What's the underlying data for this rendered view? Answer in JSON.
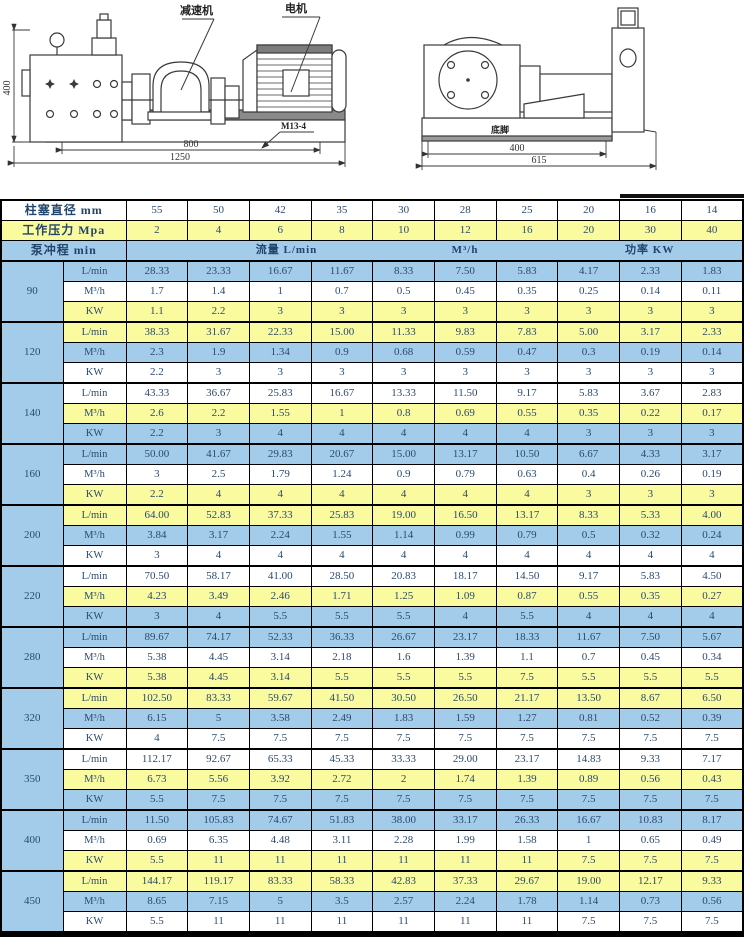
{
  "diagram": {
    "label_reducer": "减速机",
    "label_motor": "电机",
    "label_bolt": "M13-4",
    "label_foot": "底脚",
    "dim_left_height": "400",
    "dim_base": "800",
    "dim_total": "1250",
    "dim_side_base": "400",
    "dim_side_total": "615"
  },
  "table": {
    "header": {
      "diameter_label": "柱塞直径 mm",
      "diameters": [
        "55",
        "50",
        "42",
        "35",
        "30",
        "28",
        "25",
        "20",
        "16",
        "14"
      ],
      "pressure_label": "工作压力 Mpa",
      "pressures": [
        "2",
        "4",
        "6",
        "8",
        "10",
        "12",
        "16",
        "20",
        "30",
        "40"
      ],
      "stroke_label": "泵冲程 min",
      "flow_lmin_label": "流量 L/min",
      "flow_m3h_label": "M³/h",
      "power_label": "功率 KW"
    },
    "row_labels": [
      "L/min",
      "M³/h",
      "KW"
    ],
    "groups": [
      {
        "stroke": "90",
        "lmin": [
          "28.33",
          "23.33",
          "16.67",
          "11.67",
          "8.33",
          "7.50",
          "5.83",
          "4.17",
          "2.33",
          "1.83"
        ],
        "m3h": [
          "1.7",
          "1.4",
          "1",
          "0.7",
          "0.5",
          "0.45",
          "0.35",
          "0.25",
          "0.14",
          "0.11"
        ],
        "kw": [
          "1.1",
          "2.2",
          "3",
          "3",
          "3",
          "3",
          "3",
          "3",
          "3",
          "3"
        ]
      },
      {
        "stroke": "120",
        "lmin": [
          "38.33",
          "31.67",
          "22.33",
          "15.00",
          "11.33",
          "9.83",
          "7.83",
          "5.00",
          "3.17",
          "2.33"
        ],
        "m3h": [
          "2.3",
          "1.9",
          "1.34",
          "0.9",
          "0.68",
          "0.59",
          "0.47",
          "0.3",
          "0.19",
          "0.14"
        ],
        "kw": [
          "2.2",
          "3",
          "3",
          "3",
          "3",
          "3",
          "3",
          "3",
          "3",
          "3"
        ]
      },
      {
        "stroke": "140",
        "lmin": [
          "43.33",
          "36.67",
          "25.83",
          "16.67",
          "13.33",
          "11.50",
          "9.17",
          "5.83",
          "3.67",
          "2.83"
        ],
        "m3h": [
          "2.6",
          "2.2",
          "1.55",
          "1",
          "0.8",
          "0.69",
          "0.55",
          "0.35",
          "0.22",
          "0.17"
        ],
        "kw": [
          "2.2",
          "3",
          "4",
          "4",
          "4",
          "4",
          "4",
          "3",
          "3",
          "3"
        ]
      },
      {
        "stroke": "160",
        "lmin": [
          "50.00",
          "41.67",
          "29.83",
          "20.67",
          "15.00",
          "13.17",
          "10.50",
          "6.67",
          "4.33",
          "3.17"
        ],
        "m3h": [
          "3",
          "2.5",
          "1.79",
          "1.24",
          "0.9",
          "0.79",
          "0.63",
          "0.4",
          "0.26",
          "0.19"
        ],
        "kw": [
          "2.2",
          "4",
          "4",
          "4",
          "4",
          "4",
          "4",
          "3",
          "3",
          "3"
        ]
      },
      {
        "stroke": "200",
        "lmin": [
          "64.00",
          "52.83",
          "37.33",
          "25.83",
          "19.00",
          "16.50",
          "13.17",
          "8.33",
          "5.33",
          "4.00"
        ],
        "m3h": [
          "3.84",
          "3.17",
          "2.24",
          "1.55",
          "1.14",
          "0.99",
          "0.79",
          "0.5",
          "0.32",
          "0.24"
        ],
        "kw": [
          "3",
          "4",
          "4",
          "4",
          "4",
          "4",
          "4",
          "4",
          "4",
          "4"
        ]
      },
      {
        "stroke": "220",
        "lmin": [
          "70.50",
          "58.17",
          "41.00",
          "28.50",
          "20.83",
          "18.17",
          "14.50",
          "9.17",
          "5.83",
          "4.50"
        ],
        "m3h": [
          "4.23",
          "3.49",
          "2.46",
          "1.71",
          "1.25",
          "1.09",
          "0.87",
          "0.55",
          "0.35",
          "0.27"
        ],
        "kw": [
          "3",
          "4",
          "5.5",
          "5.5",
          "5.5",
          "4",
          "5.5",
          "4",
          "4",
          "4"
        ]
      },
      {
        "stroke": "280",
        "lmin": [
          "89.67",
          "74.17",
          "52.33",
          "36.33",
          "26.67",
          "23.17",
          "18.33",
          "11.67",
          "7.50",
          "5.67"
        ],
        "m3h": [
          "5.38",
          "4.45",
          "3.14",
          "2.18",
          "1.6",
          "1.39",
          "1.1",
          "0.7",
          "0.45",
          "0.34"
        ],
        "kw": [
          "5.38",
          "4.45",
          "3.14",
          "5.5",
          "5.5",
          "5.5",
          "7.5",
          "5.5",
          "5.5",
          "5.5"
        ]
      },
      {
        "stroke": "320",
        "lmin": [
          "102.50",
          "83.33",
          "59.67",
          "41.50",
          "30.50",
          "26.50",
          "21.17",
          "13.50",
          "8.67",
          "6.50"
        ],
        "m3h": [
          "6.15",
          "5",
          "3.58",
          "2.49",
          "1.83",
          "1.59",
          "1.27",
          "0.81",
          "0.52",
          "0.39"
        ],
        "kw": [
          "4",
          "7.5",
          "7.5",
          "7.5",
          "7.5",
          "7.5",
          "7.5",
          "7.5",
          "7.5",
          "7.5"
        ]
      },
      {
        "stroke": "350",
        "lmin": [
          "112.17",
          "92.67",
          "65.33",
          "45.33",
          "33.33",
          "29.00",
          "23.17",
          "14.83",
          "9.33",
          "7.17"
        ],
        "m3h": [
          "6.73",
          "5.56",
          "3.92",
          "2.72",
          "2",
          "1.74",
          "1.39",
          "0.89",
          "0.56",
          "0.43"
        ],
        "kw": [
          "5.5",
          "7.5",
          "7.5",
          "7.5",
          "7.5",
          "7.5",
          "7.5",
          "7.5",
          "7.5",
          "7.5"
        ]
      },
      {
        "stroke": "400",
        "lmin": [
          "11.50",
          "105.83",
          "74.67",
          "51.83",
          "38.00",
          "33.17",
          "26.33",
          "16.67",
          "10.83",
          "8.17"
        ],
        "m3h": [
          "0.69",
          "6.35",
          "4.48",
          "3.11",
          "2.28",
          "1.99",
          "1.58",
          "1",
          "0.65",
          "0.49"
        ],
        "kw": [
          "5.5",
          "11",
          "11",
          "11",
          "11",
          "11",
          "11",
          "7.5",
          "7.5",
          "7.5"
        ]
      },
      {
        "stroke": "450",
        "lmin": [
          "144.17",
          "119.17",
          "83.33",
          "58.33",
          "42.83",
          "37.33",
          "29.67",
          "19.00",
          "12.17",
          "9.33"
        ],
        "m3h": [
          "8.65",
          "7.15",
          "5",
          "3.5",
          "2.57",
          "2.24",
          "1.78",
          "1.14",
          "0.73",
          "0.56"
        ],
        "kw": [
          "5.5",
          "11",
          "11",
          "11",
          "11",
          "11",
          "11",
          "7.5",
          "7.5",
          "7.5"
        ]
      }
    ]
  },
  "colors": {
    "blue": "#a2ccea",
    "yellow": "#fafa9e",
    "text": "#2b4a6f",
    "border": "#000000"
  }
}
